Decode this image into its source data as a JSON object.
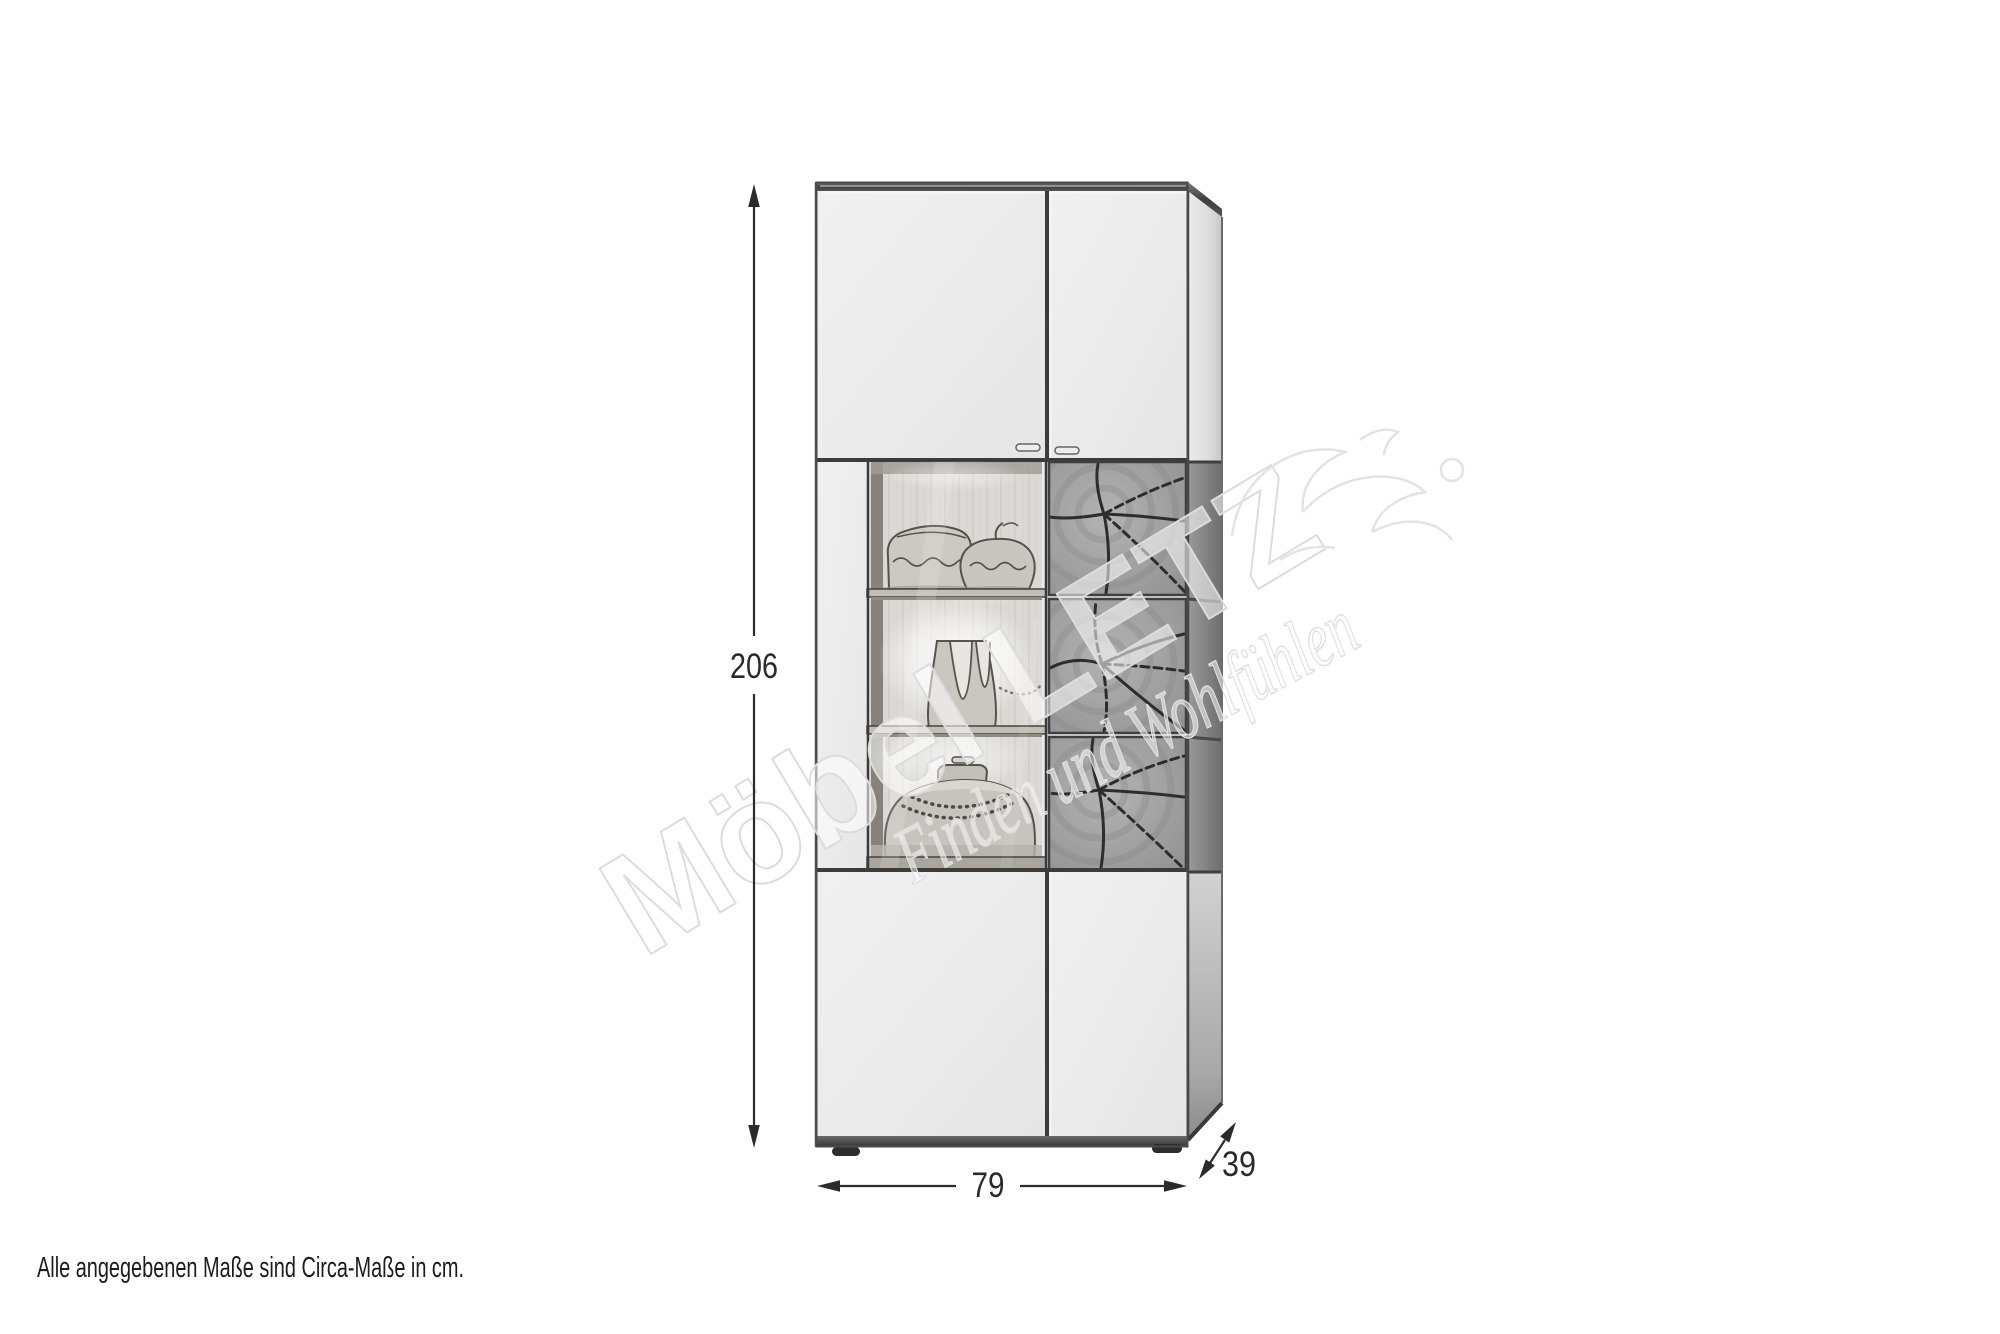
{
  "canvas": {
    "width": 2000,
    "height": 1334,
    "background": "#ffffff"
  },
  "colors": {
    "dimension_line": "#2b2b2b",
    "label_text": "#2a2a2a",
    "caption_text": "#1c1c1c",
    "door_fill": "#ebebeb",
    "pattern_panel_fill": "#a2a2a2",
    "frame_dark": "#3c3c3c",
    "watermark_line": "#dedede"
  },
  "dimension_labels": {
    "height": "206",
    "width": "79",
    "depth": "39"
  },
  "caption": {
    "text": "Alle angegebenen Maße sind Circa-Maße in cm."
  },
  "watermark": {
    "brand": "Möbel LETZ",
    "slogan": "Finden und Wohlfühlen"
  }
}
